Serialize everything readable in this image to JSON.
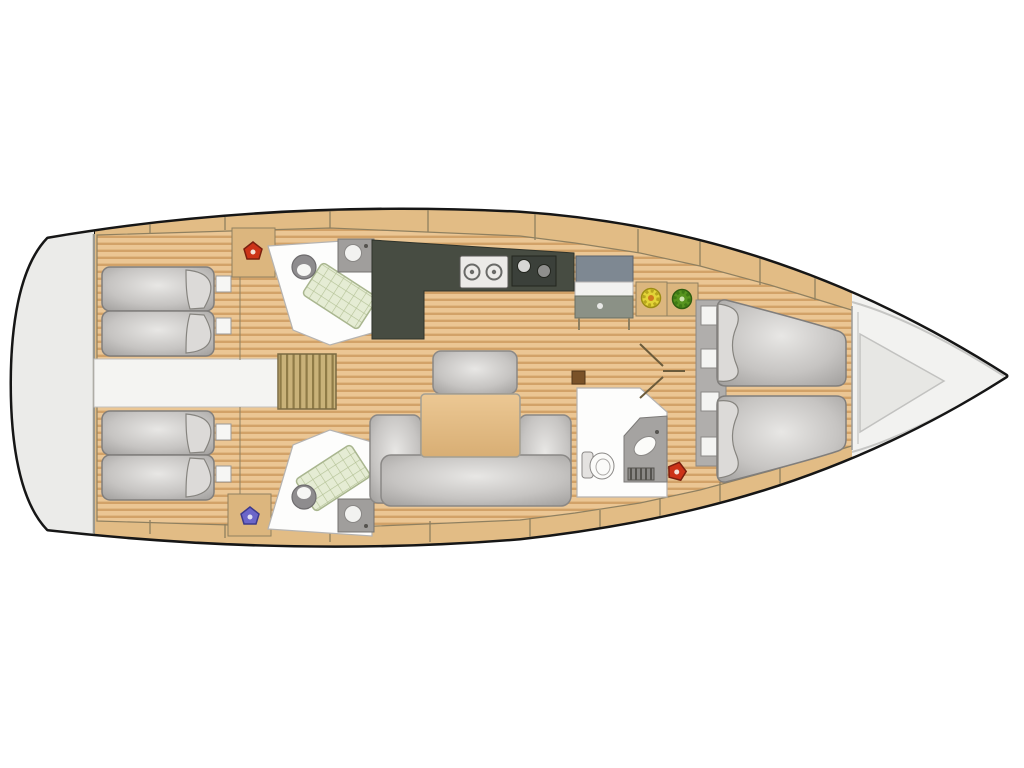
{
  "meta": {
    "description": "Top-view interior floor plan of a sailing yacht (no visible text in image)",
    "orientation": "stern-left-bow-right"
  },
  "palette": {
    "background": "#ffffff",
    "hull_outline": "#161616",
    "hull_fill": "#f2f2f0",
    "stern_fill": "#ebebe9",
    "deck_wood": "#e2bc85",
    "plank_light": "#ebc694",
    "plank_dark": "#d2a268",
    "seam_line": "#8f8060",
    "counter_dark": "#474c42",
    "sink_dark": "#3b403a",
    "table_wood": "#e5bf88",
    "steps_khaki": "#c9b279",
    "bathroom_white": "#fdfdfc",
    "shower_tray": "#e5ecd4",
    "cushion_gray": "#c6c4c2",
    "nav_desk_top": "#7e8892",
    "nav_desk_base": "#8b9186",
    "mast_step": "#7a5228",
    "icon_red": "#cc3318",
    "icon_blue": "#6b66c9",
    "icon_yellow": "#e3d438",
    "icon_green": "#57941f"
  },
  "regions": {
    "stern_platform": "stern platform",
    "aft_cabin_port": "aft double cabin (top)",
    "aft_cabin_starboard": "aft double cabin (bottom)",
    "engine_compartment": "engine compartment / passage",
    "companionway_steps": "companionway steps",
    "aft_head_port": "aft head with shower (top)",
    "aft_head_starboard": "aft head with shower (bottom)",
    "galley": "L-shaped galley with stove and sink",
    "nav_station": "chart table / nav station",
    "salon": "salon with U-settee and table",
    "forward_head": "forward head with vanity",
    "forward_cabin": "forward V-berth cabin",
    "bow_locker": "bow / anchor locker"
  },
  "icons": [
    {
      "name": "red-marker-aft-port",
      "color_key": "icon_red"
    },
    {
      "name": "blue-marker-aft-starboard",
      "color_key": "icon_blue"
    },
    {
      "name": "yellow-rosette-marker",
      "color_key": "icon_yellow"
    },
    {
      "name": "green-rosette-marker",
      "color_key": "icon_green"
    },
    {
      "name": "red-marker-forward",
      "color_key": "icon_red"
    }
  ]
}
